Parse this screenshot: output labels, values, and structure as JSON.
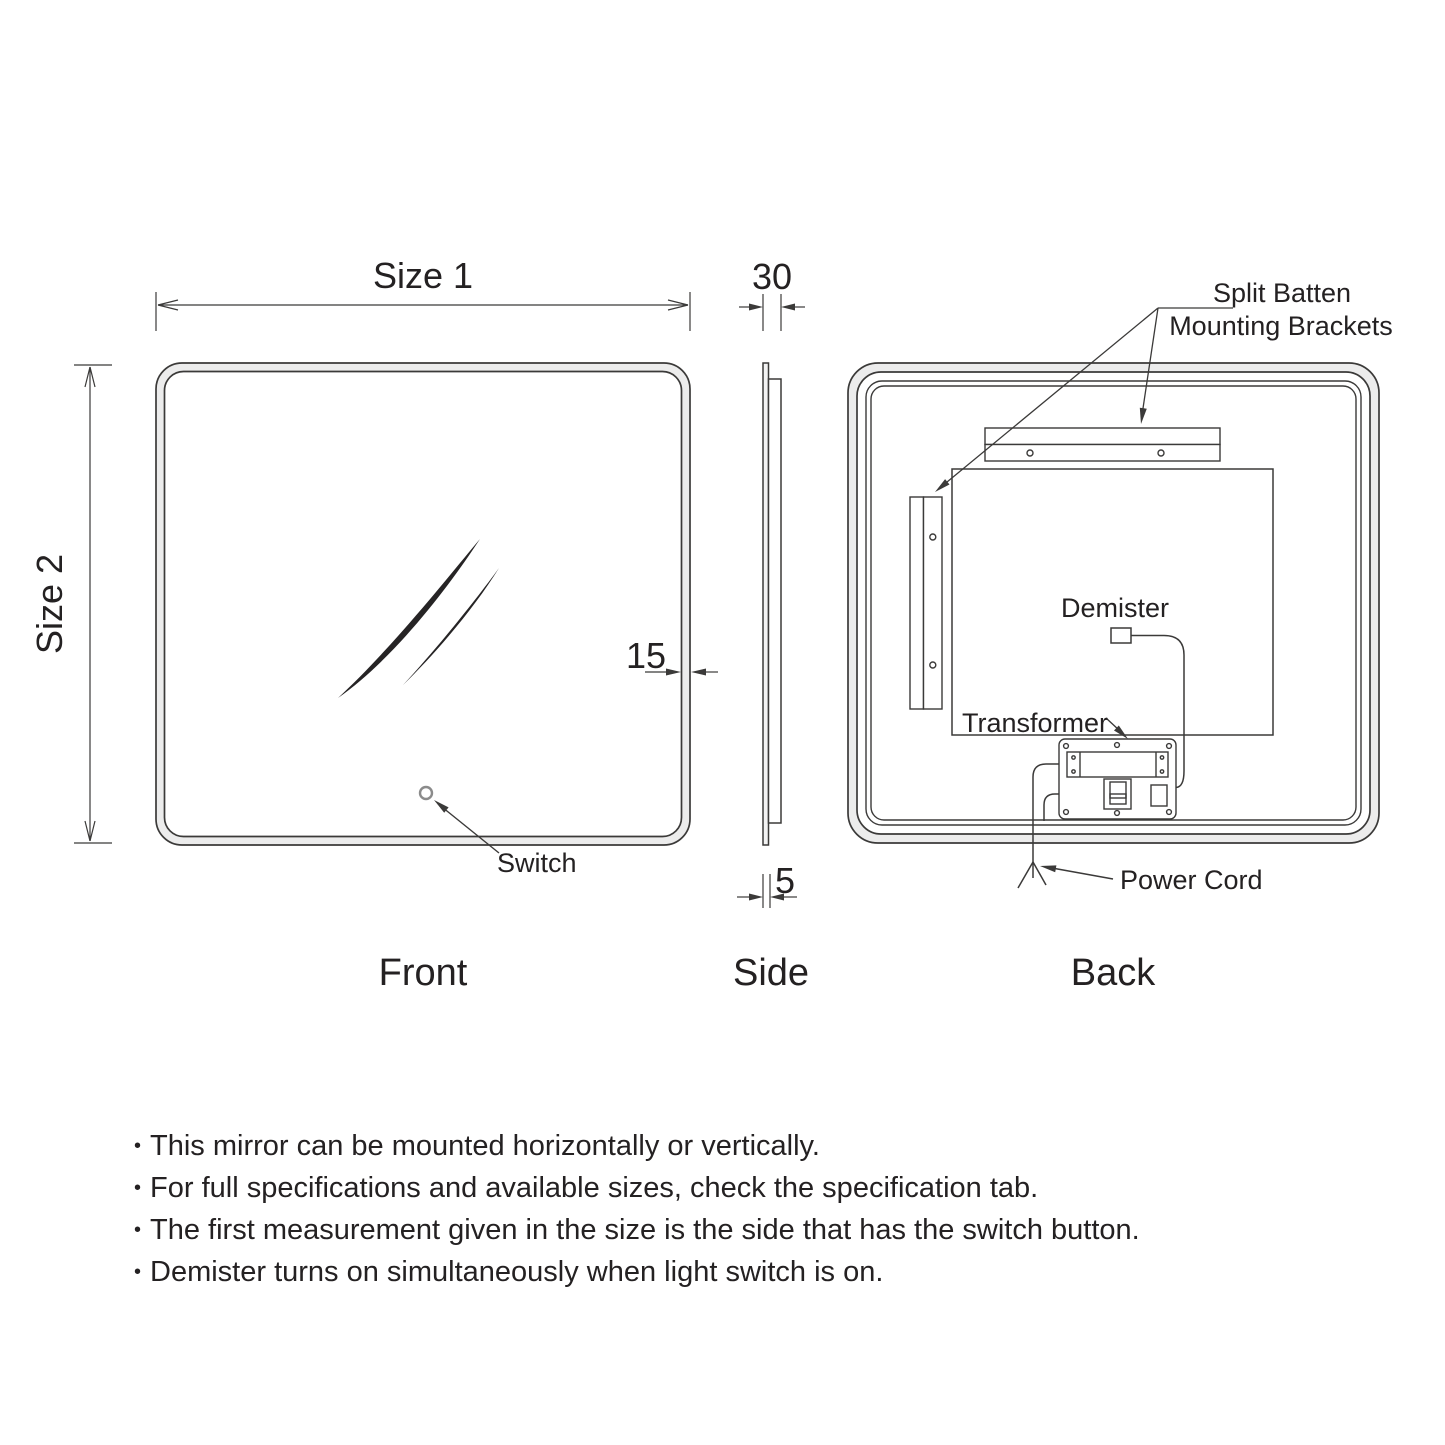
{
  "diagram": {
    "views": {
      "front_label": "Front",
      "side_label": "Side",
      "back_label": "Back"
    },
    "dimensions": {
      "size1": "Size 1",
      "size2": "Size 2",
      "depth_30": "30",
      "frame_15": "15",
      "glass_5": "5"
    },
    "annotations": {
      "switch": "Switch",
      "demister": "Demister",
      "transformer": "Transformer",
      "power_cord": "Power Cord",
      "split_batten_line1": "Split Batten",
      "split_batten_line2": "Mounting Brackets"
    }
  },
  "notes": {
    "bullet": "•",
    "items": [
      "This mirror can be mounted horizontally or vertically.",
      "For full specifications and available sizes, check the specification tab.",
      "The first measurement given in the size is the side that has the switch button.",
      "Demister turns on simultaneously when light switch is on."
    ]
  },
  "colors": {
    "line": "#3b3a39",
    "text": "#242122",
    "band": "#ececec"
  }
}
